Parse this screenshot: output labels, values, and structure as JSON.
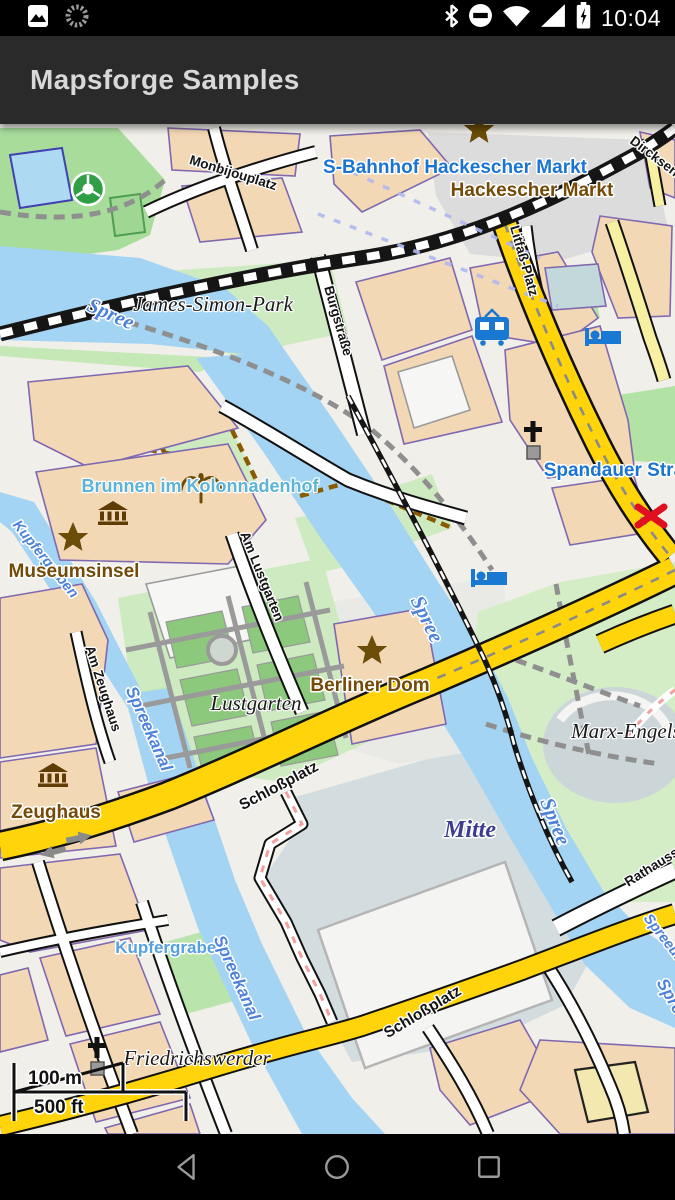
{
  "status_bar": {
    "time": "10:04",
    "left_icons": [
      "gallery-icon",
      "spinner-icon"
    ],
    "right_icons": [
      "bluetooth-icon",
      "do-not-disturb-icon",
      "wifi-icon",
      "cell-signal-icon",
      "battery-charging-icon"
    ]
  },
  "app_bar": {
    "title": "Mapsforge Samples"
  },
  "map": {
    "labels": [
      "Monbijouplatz",
      "S-Bahnhof Hackescher Markt",
      "Hackescher Markt",
      "Dircksenstraße",
      "Litfaß-Platz",
      "Burgstraße",
      "James-Simon-Park",
      "Spree",
      "Spree",
      "Spree",
      "Spreeufer",
      "Spree",
      "Kupfergraben",
      "Brunnen im Kolonnadenhof",
      "Museumsinsel",
      "Spandauer Straße",
      "Am Lustgarten",
      "Berliner Dom",
      "Lustgarten",
      "Marx-Engels-Forum",
      "Am Zeughaus",
      "Spreekanal",
      "Zeughaus",
      "Schloßplatz",
      "Mitte",
      "Rathausstraße",
      "Kupfergraben",
      "Spreekanal",
      "Friedrichswerder",
      "Schloßplatz"
    ],
    "scale_bar": {
      "metric": "100 m",
      "imperial": "500 ft"
    },
    "poi_icons": [
      "star-icon",
      "museum-icon",
      "fountain-icon",
      "tram-stop-icon",
      "hotel-icon",
      "church-icon",
      "crossing-x-icon",
      "oneway-arrow-icon",
      "soccer-pitch-icon"
    ],
    "colors": {
      "water": "#a4d4f4",
      "park": "#cdeac0",
      "building": "#f3d8b6",
      "building_outline": "#7f68b0",
      "primary_road": "#ffd40a",
      "minor_road": "#f7f0a2",
      "water_label": "#4d82d8",
      "poi_blue": "#1a75d2",
      "poi_brown": "#734a08",
      "district_label": "#3b3b8f"
    }
  },
  "nav_bar": {
    "buttons": [
      "back",
      "home",
      "recents"
    ]
  }
}
